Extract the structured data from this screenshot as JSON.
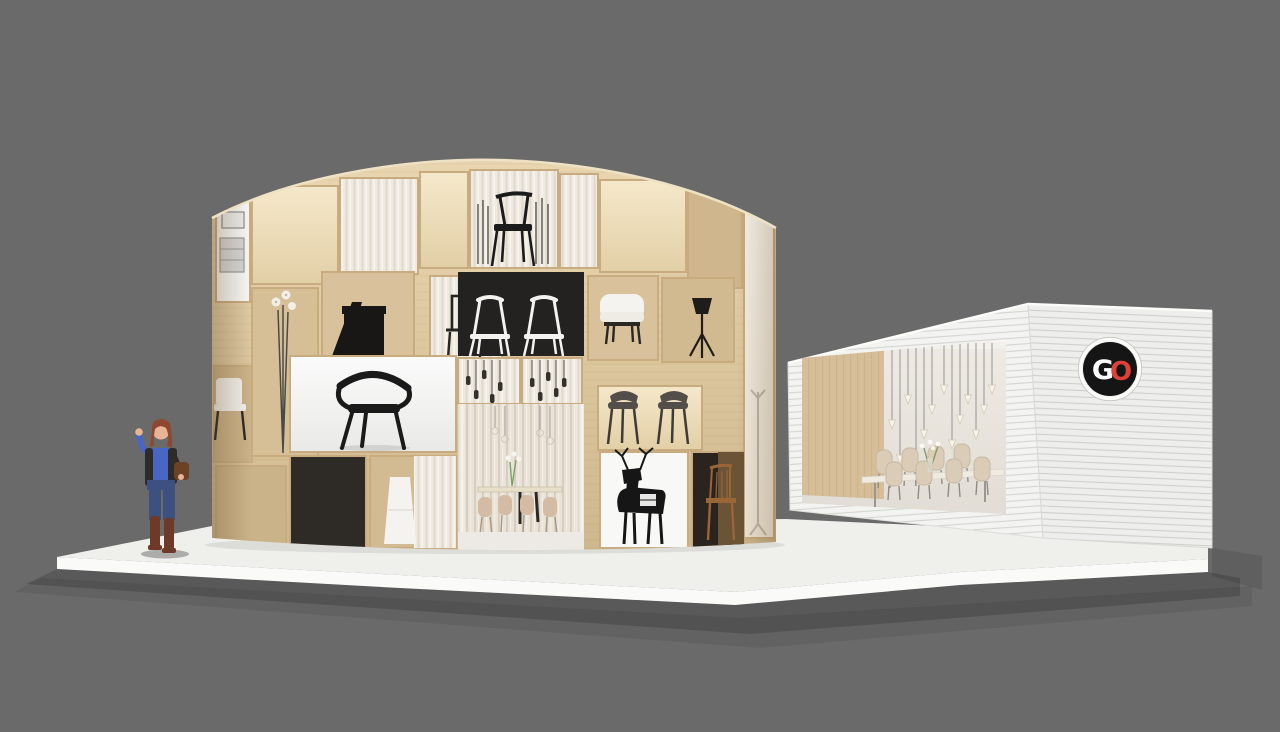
{
  "scene": {
    "description": "3D rendering of a furniture exhibition stand: a circular plywood shelf pavilion with display cubbies beside a white slatted logo building, on a white platform against a gray studio background",
    "figure": "woman waving"
  },
  "colors": {
    "background": "#6A6A6A",
    "platform_top": "#EFEFEC",
    "platform_front": "#FAFAF9",
    "panel_black": "#23201D",
    "display_white": "#F8F8F7",
    "curtain": "#EFEAE1",
    "building_white": "#F3F3F1",
    "logo_black": "#151515",
    "logo_red": "#DF4038",
    "logo_white": "#FFFFFF",
    "chair_beige": "#D9CBB5",
    "interior_wood": "#D5BE98",
    "skin": "#E9B493",
    "hair": "#8E4830",
    "denim": "#3C5180",
    "sweater_blue": "#4A66C4",
    "boots": "#6E3A27",
    "vest": "#2E2B28"
  },
  "logo": {
    "letters": {
      "g": "G",
      "o": "O"
    },
    "style": "black circular badge with interlocking white G and red O"
  },
  "pavilion": {
    "exhibits": [
      "display-cabinet-poster",
      "flower-floor-lamp",
      "black-desk",
      "wire-frame-chair",
      "black-chair-with-reeds",
      "white-chairs-on-black",
      "white-armchair",
      "tripod-floor-lamp",
      "designer-chair-poster",
      "white-side-chair",
      "pendant-bulb-lamps",
      "gray-chairs-pair",
      "dining-room-entrance",
      "white-pedestal",
      "deer-sculpture",
      "wooden-chair",
      "coat-rack"
    ]
  },
  "building": {
    "interior_items": [
      "cone-pendant-lamp-cluster",
      "long-dining-table",
      "beige-shell-chairs",
      "flower-vase",
      "wood-panel-wall"
    ]
  }
}
